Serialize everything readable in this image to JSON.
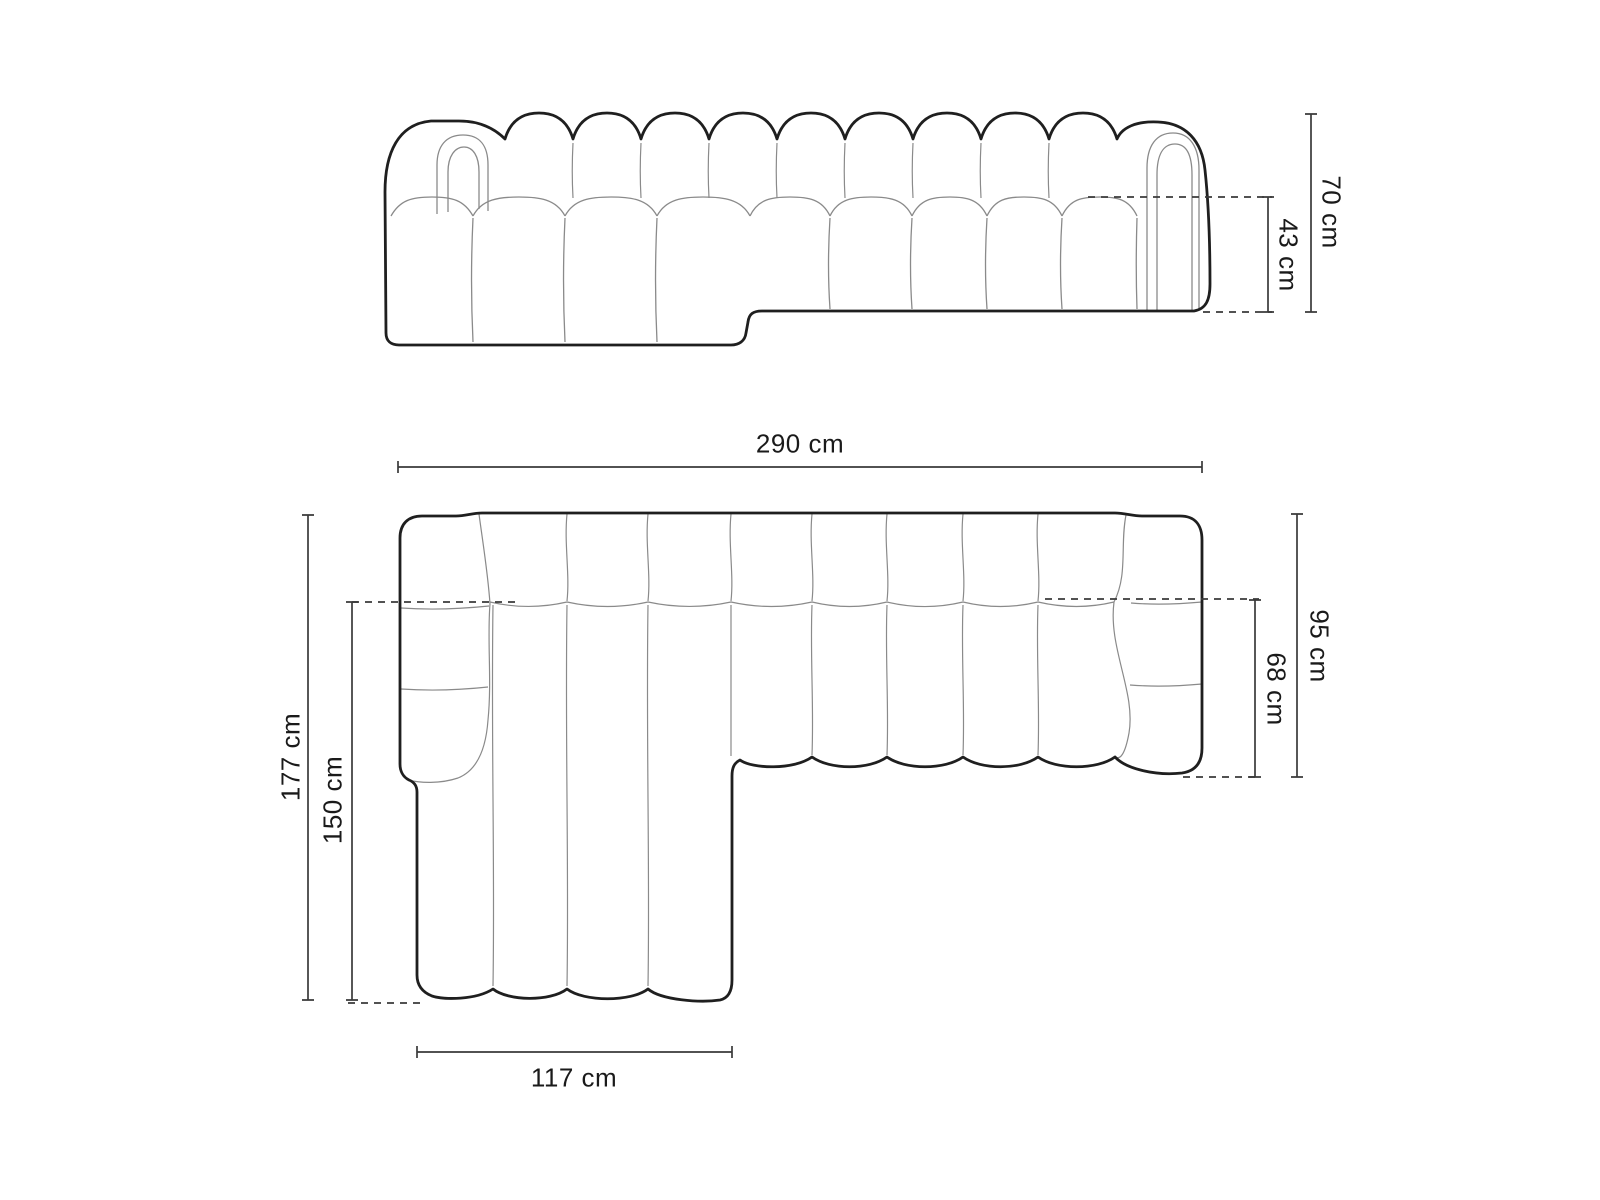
{
  "diagram": {
    "type": "furniture-dimension-drawing",
    "subject": "left-corner modular chaise sofa, channel-tufted",
    "front_view": {
      "dimensions": {
        "total_height": "70 cm",
        "seat_height": "43 cm"
      }
    },
    "plan_view": {
      "dimensions": {
        "total_width": "290 cm",
        "total_depth": "95 cm",
        "seat_depth": "68 cm",
        "chaise_total_depth": "177 cm",
        "chaise_inner_depth": "150 cm",
        "chaise_width": "117 cm"
      }
    },
    "colors": {
      "outline": "#1f1f1f",
      "seam": "#8a8a8a",
      "dimension_line": "#3a3a3a",
      "label_text": "#1a1a1a",
      "background": "#ffffff"
    }
  }
}
